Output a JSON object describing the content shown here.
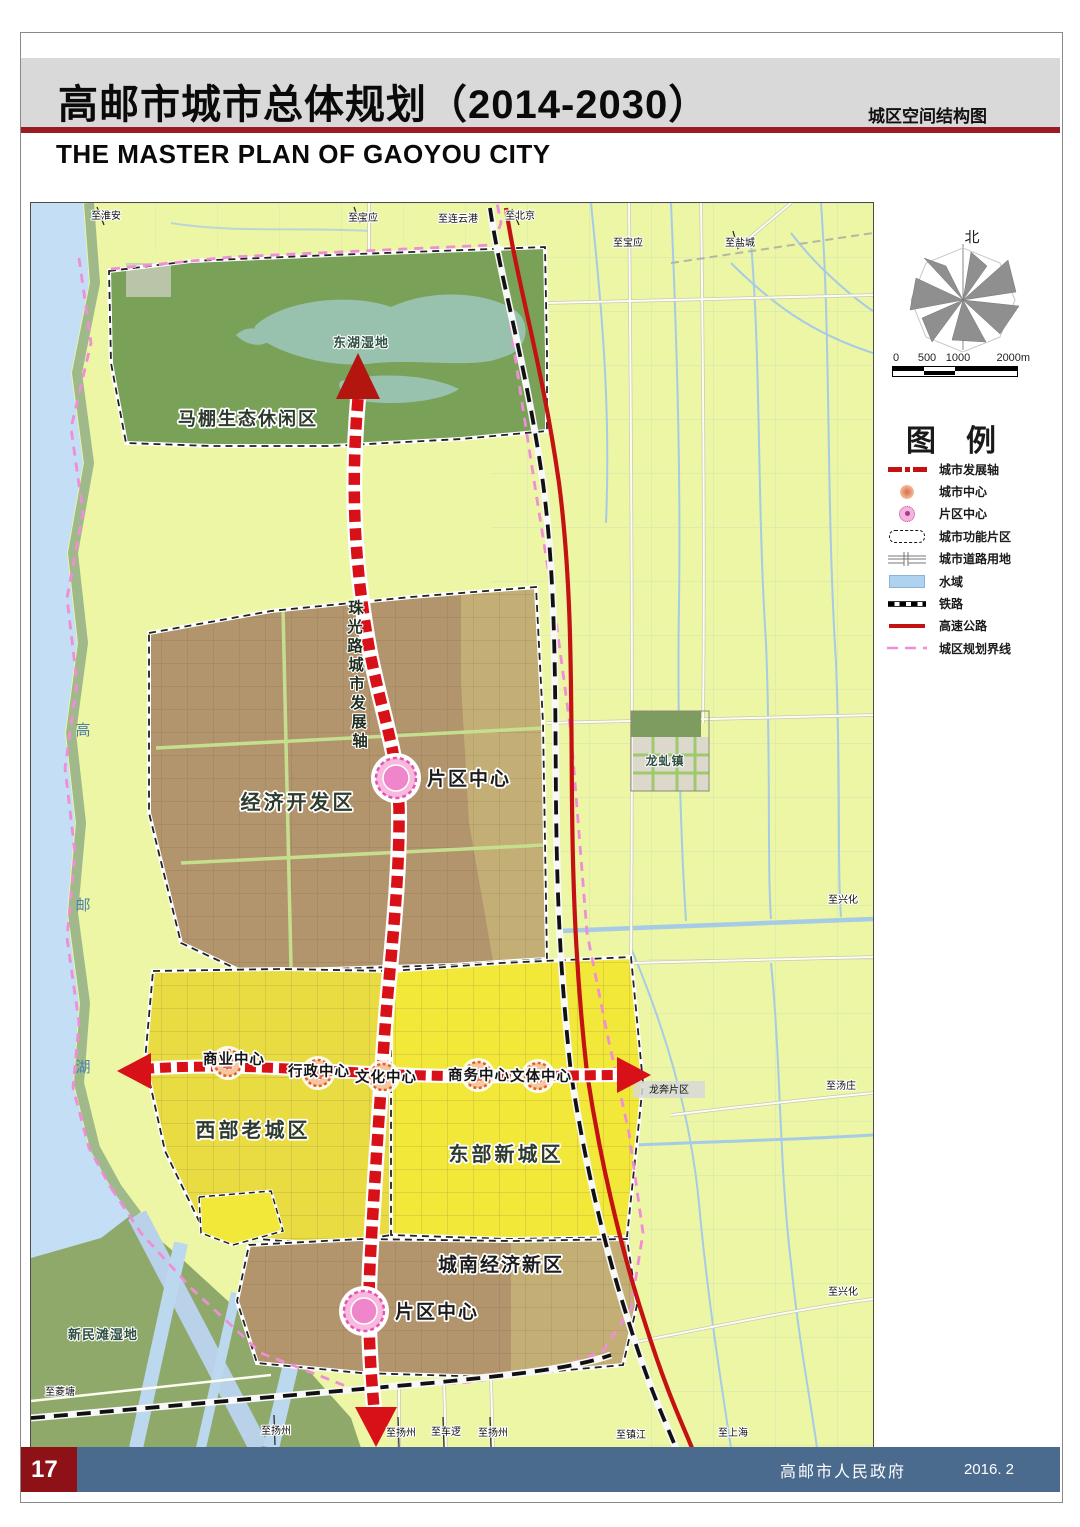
{
  "header": {
    "title": "高邮市城市总体规划（2014-2030）",
    "subtitle": "城区空间结构图",
    "title_en": "THE MASTER PLAN OF GAOYOU CITY"
  },
  "map": {
    "regions": {
      "mapeng": "马棚生态休闲区",
      "donghu": "东湖湿地",
      "kaifaqu": "经济开发区",
      "xibu": "西部老城区",
      "dongbu": "东部新城区",
      "chengnan": "城南经济新区",
      "xinmintan": "新民滩湿地",
      "longqiu": "龙虬镇",
      "longben": "龙奔片区"
    },
    "axis_chars": [
      "珠",
      "光",
      "路",
      "城",
      "市",
      "发",
      "展",
      "轴"
    ],
    "lake_chars": [
      "高",
      "邮",
      "湖"
    ],
    "centers": {
      "district1": "片区中心",
      "district2": "片区中心",
      "shangye": "商业中心",
      "xingzheng": "行政中心",
      "wenhua": "文化中心",
      "shangwu": "商务中心",
      "wenti": "文体中心"
    },
    "edge_labels": {
      "top": [
        "至淮安",
        "至宝应",
        "至连云港",
        "至北京",
        "至宝应",
        "至盐城"
      ],
      "right": [
        "至兴化",
        "至汤庄",
        "至兴化"
      ],
      "bottom": [
        "至菱塘",
        "至扬州",
        "至扬州",
        "至车逻",
        "至扬州",
        "至镇江",
        "至上海"
      ]
    }
  },
  "panel": {
    "north_label": "北",
    "scale": {
      "labels": [
        "0",
        "500",
        "1000",
        "2000m"
      ]
    },
    "legend": {
      "title": "图例",
      "items": [
        {
          "label": "城市发展轴"
        },
        {
          "label": "城市中心"
        },
        {
          "label": "片区中心"
        },
        {
          "label": "城市功能片区"
        },
        {
          "label": "城市道路用地"
        },
        {
          "label": "水域"
        },
        {
          "label": "铁路"
        },
        {
          "label": "高速公路"
        },
        {
          "label": "城区规划界线"
        }
      ]
    }
  },
  "footer": {
    "page": "17",
    "publisher": "高邮市人民政府",
    "date": "2016. 2"
  },
  "colors": {
    "title_rule_red": "#9c1a23",
    "axis_red": "#d81118",
    "expressway_red": "#c41212",
    "boundary_pink": "#ef8ed6",
    "water_blue": "#c3def5",
    "plain_green": "#ecf6a4",
    "eco_green": "#79a258",
    "urban_brown": "#b2946d",
    "oldtown_yellow": "#e9dc43",
    "newtown_yellow": "#f2e83a",
    "footer_blue": "#4a6a8e",
    "pagenum_red": "#8d1117"
  }
}
